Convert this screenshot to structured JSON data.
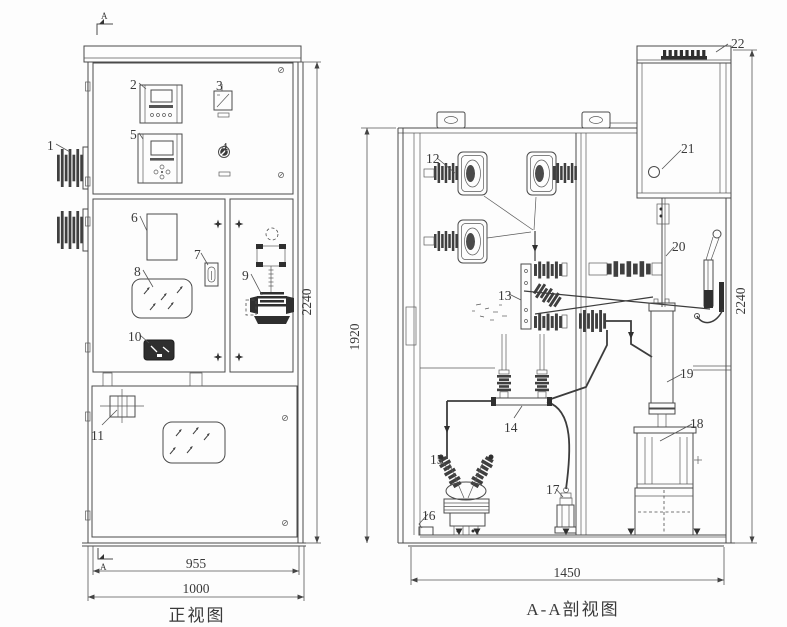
{
  "front_view": {
    "caption": "正视图",
    "marker_top": "A",
    "marker_bottom": "A",
    "dims": {
      "door_width": "955",
      "width": "1000",
      "height": "2240"
    },
    "labels": {
      "1": "1",
      "2": "2",
      "3": "3",
      "4": "4",
      "5": "5",
      "6": "6",
      "7": "7",
      "8": "8",
      "9": "9",
      "10": "10",
      "11": "11"
    }
  },
  "section_view": {
    "caption": "A-A剖视图",
    "dims": {
      "base_width": "1450",
      "body_height": "1920",
      "height": "2240"
    },
    "labels": {
      "12": "12",
      "13": "13",
      "14": "14",
      "15": "15",
      "16": "16",
      "17": "17",
      "18": "18",
      "19": "19",
      "20": "20",
      "21": "21",
      "22": "22"
    }
  }
}
